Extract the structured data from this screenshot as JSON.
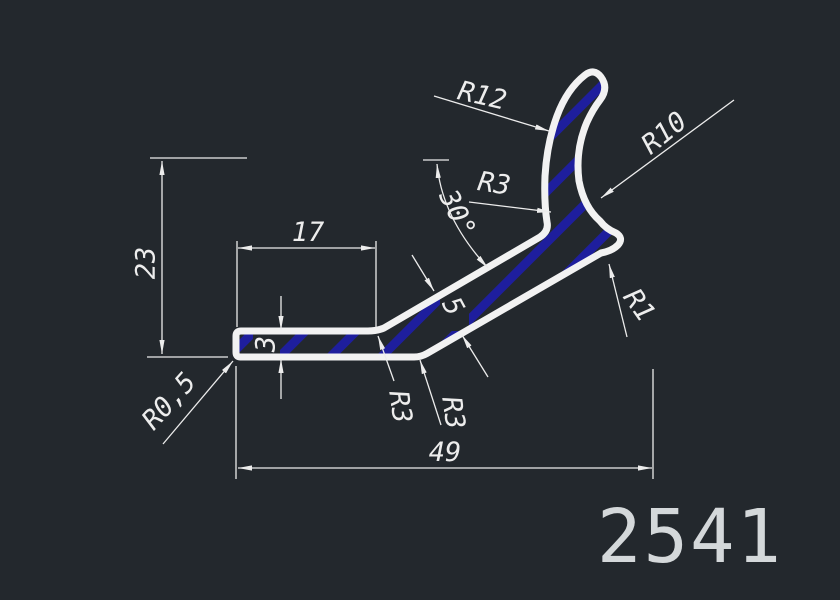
{
  "drawing": {
    "part_number": "2541",
    "type": "extrusion-profile-section",
    "colors": {
      "background": "#23282d",
      "outline": "#f2f2f2",
      "hatch": "#1e1e9d",
      "dimension": "#ececec"
    }
  },
  "labels": {
    "r12": "R12",
    "r10": "R10",
    "r3_top": "R3",
    "angle": "30°",
    "height": "23",
    "flat_length": "17",
    "flat_thickness": "3",
    "arm_thickness": "5",
    "r0_5": "R0,5",
    "r3_bottom_left": "R3",
    "r3_bottom_right": "R3",
    "r1": "R1",
    "total_width": "49",
    "part_number": "2541"
  }
}
